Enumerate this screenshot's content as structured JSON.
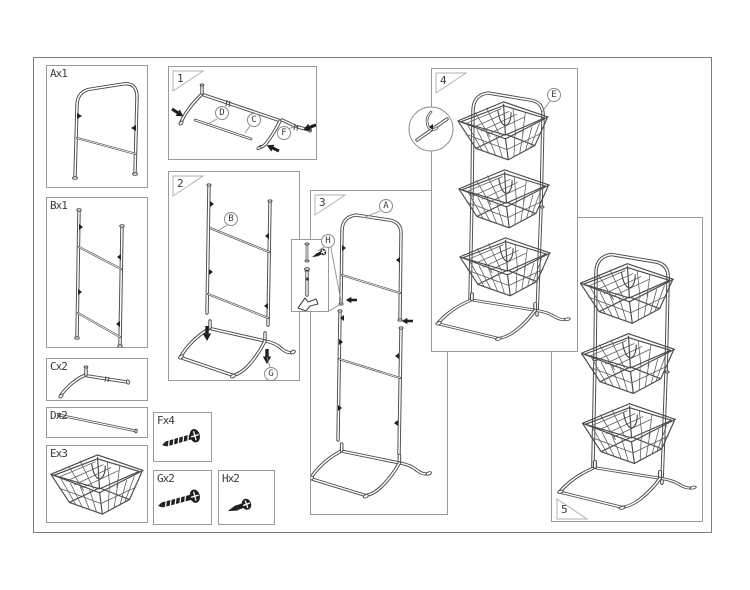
{
  "colors": {
    "background": "#ffffff",
    "line": "#4a4a4a",
    "solid_fill": "#1f1f1f",
    "box_border": "#9a9a9a",
    "outer_border": "#7c7c7c",
    "text": "#3c3c3c"
  },
  "parts": [
    {
      "label": "Ax1"
    },
    {
      "label": "Bx1"
    },
    {
      "label": "Cx2"
    },
    {
      "label": "Dx2"
    },
    {
      "label": "Ex3"
    }
  ],
  "hardware": [
    {
      "label": "Fx4"
    },
    {
      "label": "Gx2"
    },
    {
      "label": "Hx2"
    }
  ],
  "steps": [
    {
      "number": "1"
    },
    {
      "number": "2"
    },
    {
      "number": "3"
    },
    {
      "number": "4"
    },
    {
      "number": "5"
    }
  ],
  "callouts": [
    {
      "label": "D"
    },
    {
      "label": "C"
    },
    {
      "label": "F"
    },
    {
      "label": "B"
    },
    {
      "label": "G"
    },
    {
      "label": "A"
    },
    {
      "label": "H"
    },
    {
      "label": "E"
    }
  ]
}
